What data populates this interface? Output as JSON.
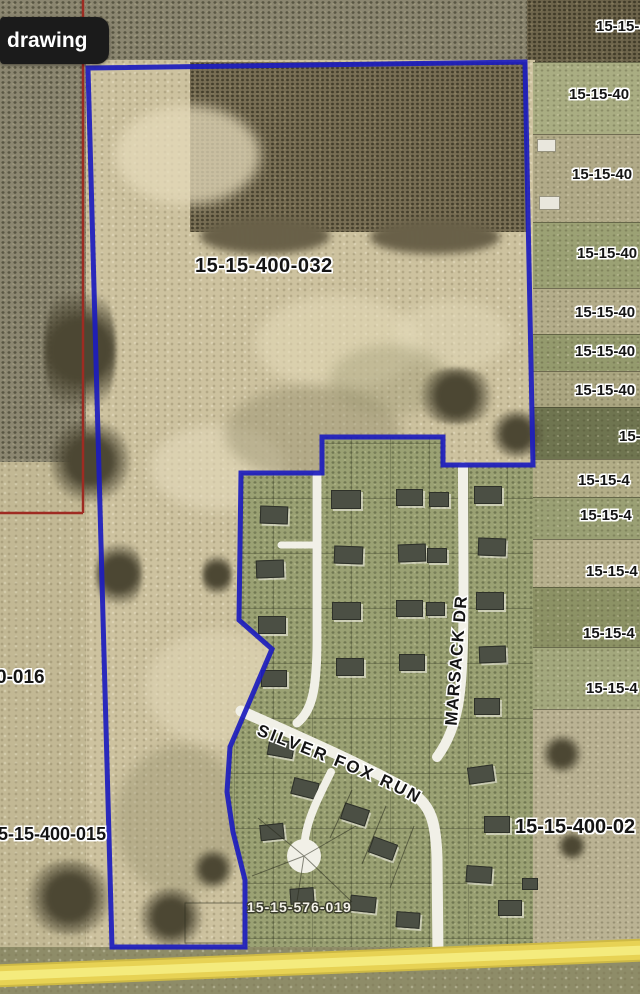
{
  "overlay": {
    "tool_label": "drawing"
  },
  "parcels": {
    "main": "15-15-400-032",
    "bottom_right": "15-15-400-02",
    "subdivision": "15-15-576-019",
    "left": [
      {
        "text": "0-016"
      },
      {
        "text": "5-15-400-015"
      }
    ],
    "right": [
      {
        "text": "15-15-"
      },
      {
        "text": "15-15-40"
      },
      {
        "text": "15-15-40"
      },
      {
        "text": "15-15-40"
      },
      {
        "text": "15-15-40"
      },
      {
        "text": "15-15-40"
      },
      {
        "text": "15-15-40"
      },
      {
        "text": "15-"
      },
      {
        "text": "15-15-4"
      },
      {
        "text": "15-15-4"
      },
      {
        "text": "15-15-4"
      },
      {
        "text": "15-15-4"
      },
      {
        "text": "15-15-4"
      }
    ]
  },
  "streets": {
    "marsack": "MARSACK DR",
    "silver_fox": "SILVER FOX RUN"
  },
  "colors": {
    "boundary_blue": "#1c1cbe",
    "section_red": "#9e2b22",
    "road_white": "#f1f0e7",
    "road_yellow": "#e7d254"
  }
}
